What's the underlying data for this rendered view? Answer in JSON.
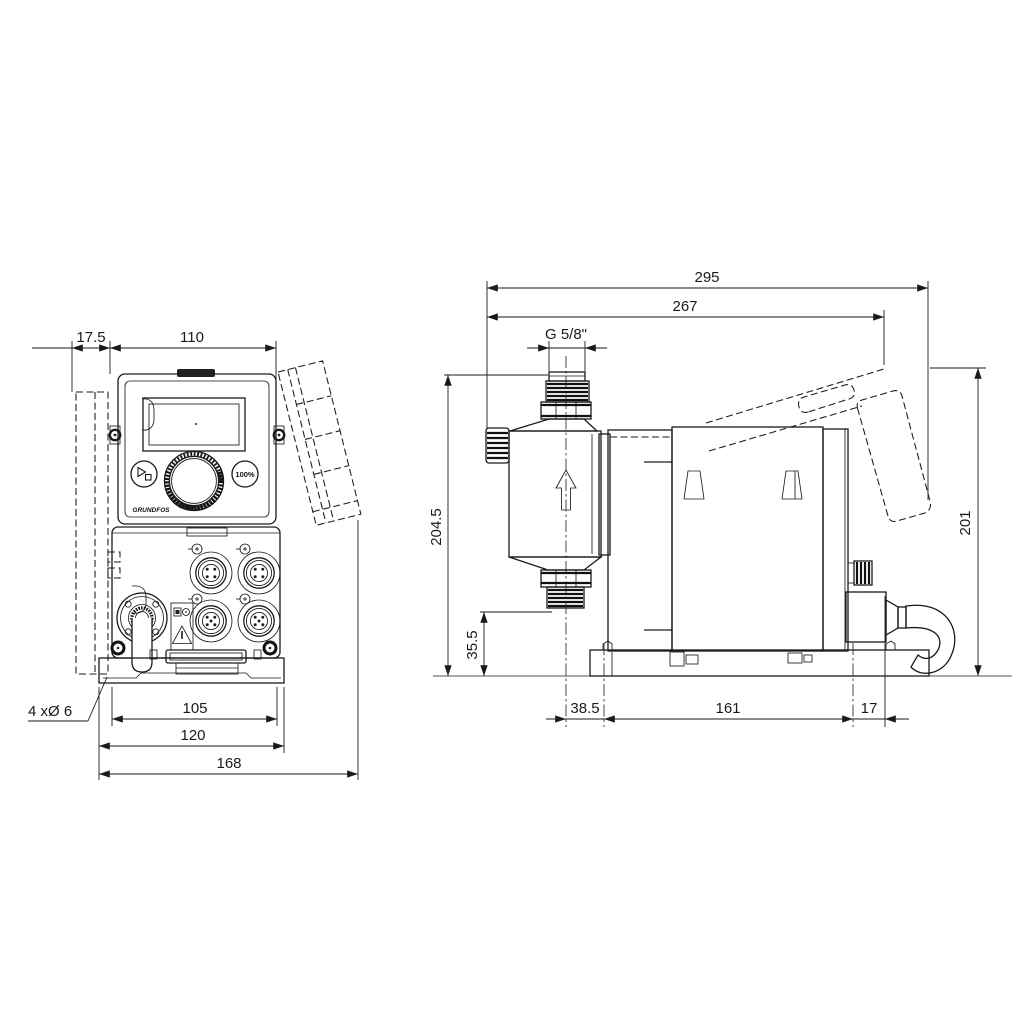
{
  "title": "Dosing pump dimensional drawing",
  "colors": {
    "background": "#ffffff",
    "line": "#1a1a1a"
  },
  "front_view": {
    "dims": {
      "bracket_depth": "17.5",
      "width": "110",
      "hole_spacing": "105",
      "plate_width": "120",
      "overall_width": "168"
    },
    "mounting_holes_callout": "4 xØ 6",
    "panel": {
      "logo": "GRUNDFOS",
      "percent_button": "100%"
    },
    "icons": {
      "start_stop": "play-stop-icon",
      "warning": "warning-triangle-icon",
      "connectors": "m12-connector-icon"
    }
  },
  "side_view": {
    "dims": {
      "overall_depth": "295",
      "depth_to_bracket": "267",
      "thread": "G 5/8\"",
      "height_overall": "204.5",
      "valve_height": "35.5",
      "head_center_to_front_hole": "38.5",
      "hole_spacing": "161",
      "rear_hole_to_back": "17",
      "bracket_top_height": "201"
    },
    "icons": {
      "flow_direction": "up-arrow-icon"
    }
  }
}
